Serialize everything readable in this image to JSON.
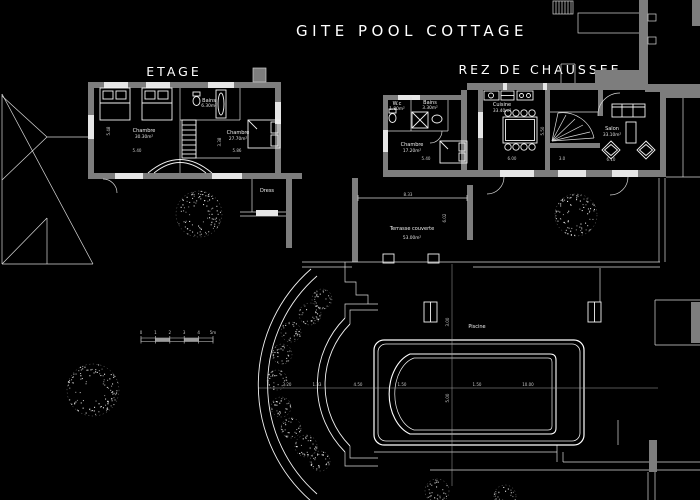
{
  "title": "GITE POOL COTTAGE",
  "etage": {
    "heading": "ETAGE",
    "chambre1": {
      "name": "Chambre",
      "area": "30.30m²"
    },
    "bains": {
      "name": "Bains",
      "area": "6.30m²"
    },
    "chambre2": {
      "name": "Chambre",
      "area": "27.70m²"
    },
    "dress": "Dress",
    "dims": {
      "h": "5.48",
      "w1": "5.40",
      "w2": "5.86",
      "stair": "3.38"
    }
  },
  "rdc": {
    "heading": "REZ DE CHAUSSEE",
    "wc": {
      "name": "W.c",
      "area": "1.80m²"
    },
    "bains": {
      "name": "Bains",
      "area": "3.30m²"
    },
    "chambre": {
      "name": "Chambre",
      "area": "17.20m²"
    },
    "cuisine": {
      "name": "Cuisine",
      "area": "33.40m²"
    },
    "salon": {
      "name": "Salon",
      "area": "33.10m²"
    },
    "dims": {
      "chambre_w": "5.40",
      "cuisine_w": "6.00",
      "cuisine_h": "5.50",
      "stair_w": "3.0",
      "salon_w": "6.10"
    }
  },
  "terrasse": {
    "name": "Terrasse couverte",
    "area": "53.00m²",
    "dims": {
      "w": "8.33",
      "h": "6.02"
    }
  },
  "piscine": {
    "name": "Piscine",
    "dims": {
      "a": "3.20",
      "b": "1.33",
      "c": "4.50",
      "d": "1.50",
      "e": "1.50",
      "f": "10.00",
      "v1": "3.00",
      "v2": "5.00"
    }
  },
  "scalebar": [
    "0",
    "1",
    "2",
    "3",
    "4",
    "5m"
  ],
  "colors": {
    "background": "#000000",
    "wall": "#7d7d7d",
    "line": "#f2f2f2",
    "dim_text": "#c9c9c9"
  }
}
